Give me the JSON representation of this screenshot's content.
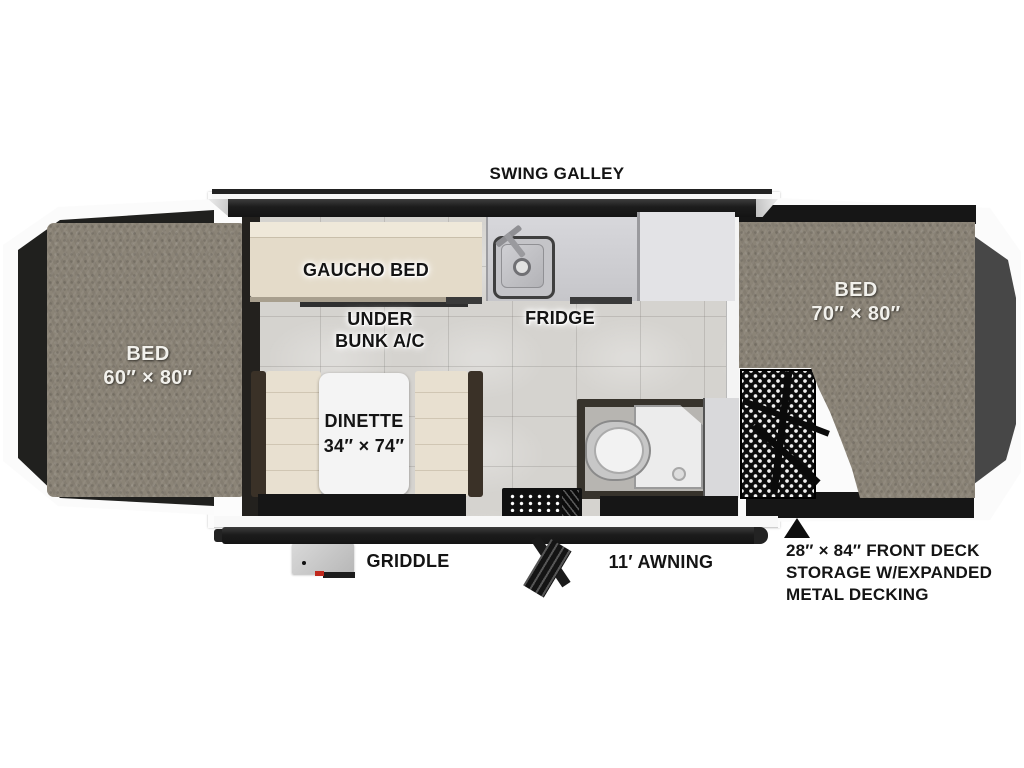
{
  "diagram": {
    "type": "rv-popup-camper-floorplan",
    "labels": {
      "swing_galley": "SWING GALLEY",
      "gaucho_bed": "GAUCHO BED",
      "under_bunk_line1": "UNDER",
      "under_bunk_line2": "BUNK A/C",
      "fridge": "FRIDGE",
      "bed_left_name": "BED",
      "bed_left_size": "60″ × 80″",
      "bed_right_name": "BED",
      "bed_right_size": "70″ × 80″",
      "dinette_name": "DINETTE",
      "dinette_size": "34″ × 74″",
      "griddle": "GRIDDLE",
      "awning": "11′ AWNING",
      "front_deck_line1": "28″ × 84″ FRONT DECK",
      "front_deck_line2": "STORAGE W/EXPANDED",
      "front_deck_line3": "METAL DECKING"
    },
    "colors": {
      "carpet": "#8b8477",
      "cushion": "#e8e0d0",
      "floor_tile": "#d5d3cf",
      "dark_panel": "#1c1c1c",
      "counter": "#cbcbcf",
      "cabinet": "#e3e3e6",
      "accent_red": "#c0281c"
    }
  }
}
